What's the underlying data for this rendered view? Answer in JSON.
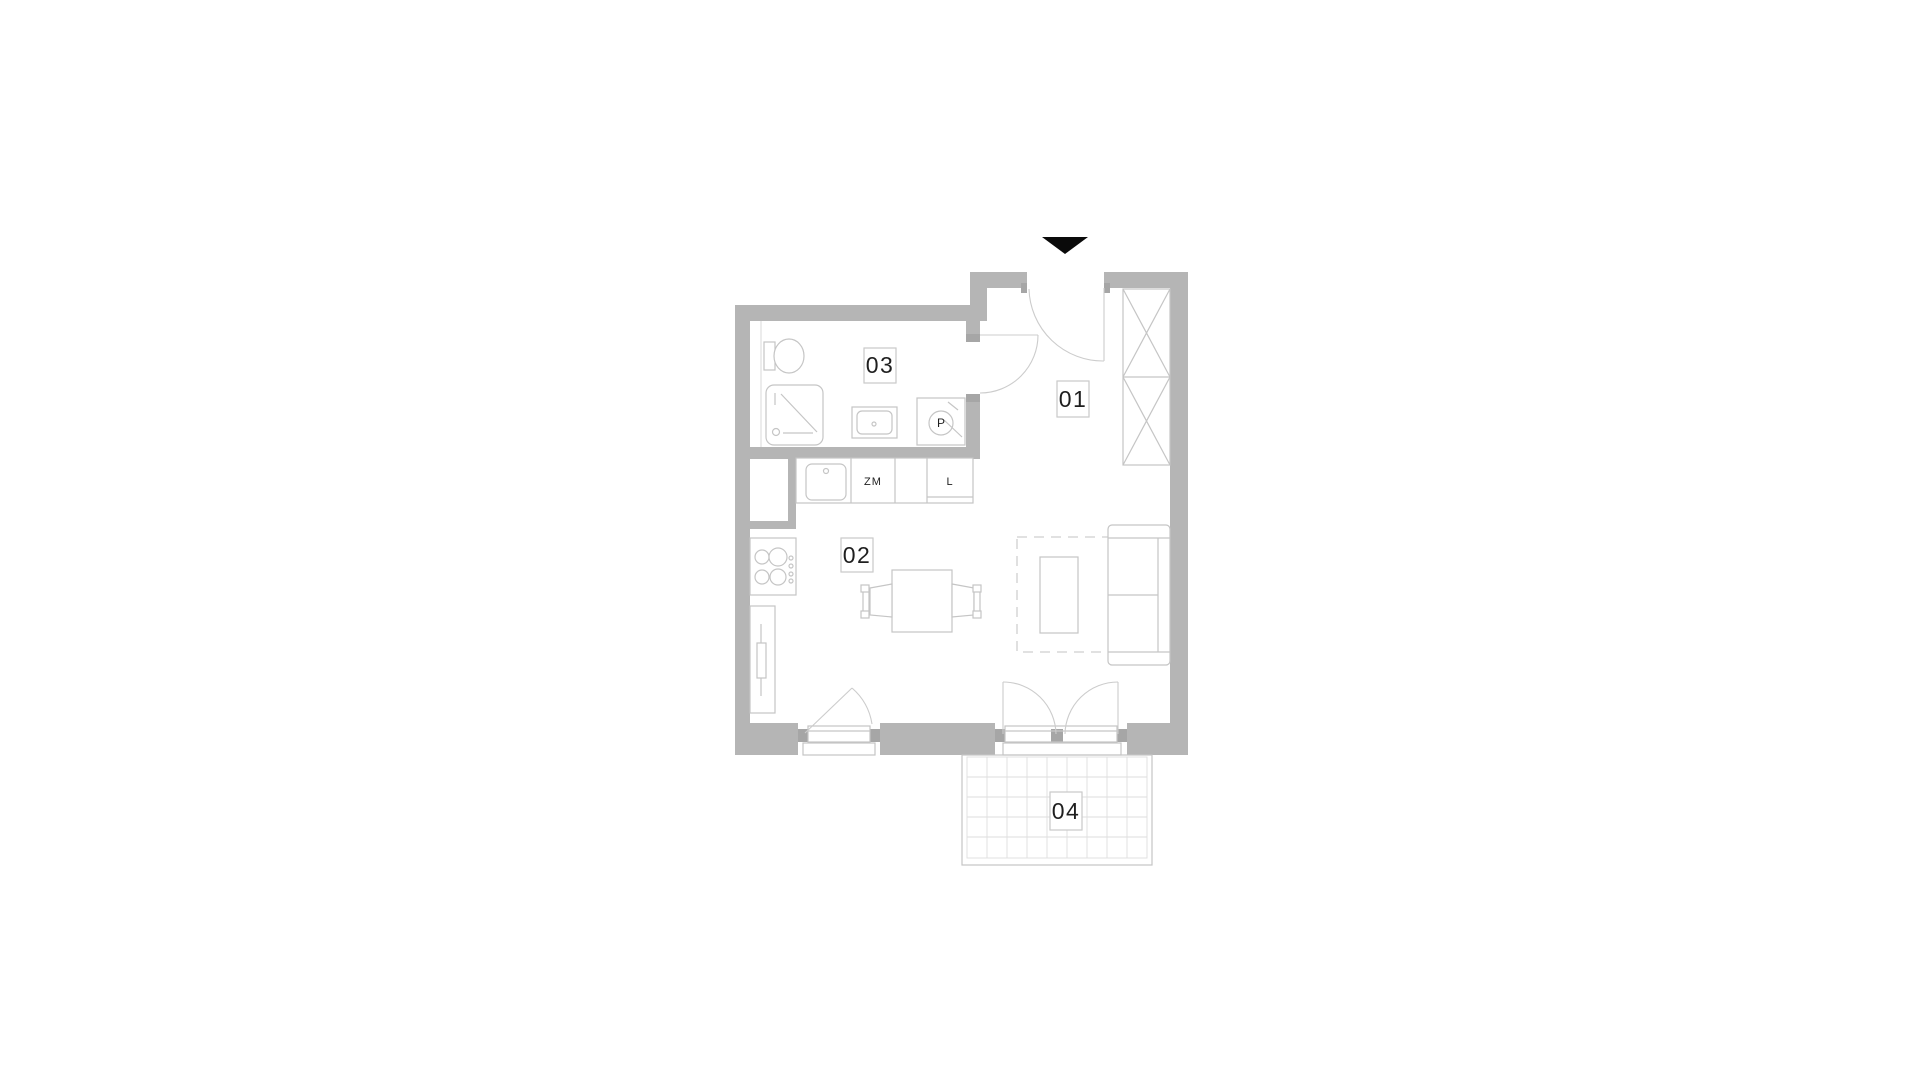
{
  "document": {
    "type": "apartment-floor-plan"
  },
  "rooms": {
    "r01": "01",
    "r02": "02",
    "r03": "03",
    "r04": "04"
  },
  "fixtures": {
    "dishwasher": "ZM",
    "fridge": "L",
    "washing_machine": "P"
  },
  "icons": {
    "entrance_arrow": "entrance-direction-triangle"
  },
  "colors": {
    "background": "#ffffff",
    "wall": "#b5b5b5",
    "door_jamb": "#a6a6a6",
    "furniture_line": "#c5c5c5",
    "light_line": "#d9d9d9",
    "balcony_grid": "#dedede",
    "text": "#1f1f1f",
    "entrance_arrow": "#0a0a0a"
  }
}
